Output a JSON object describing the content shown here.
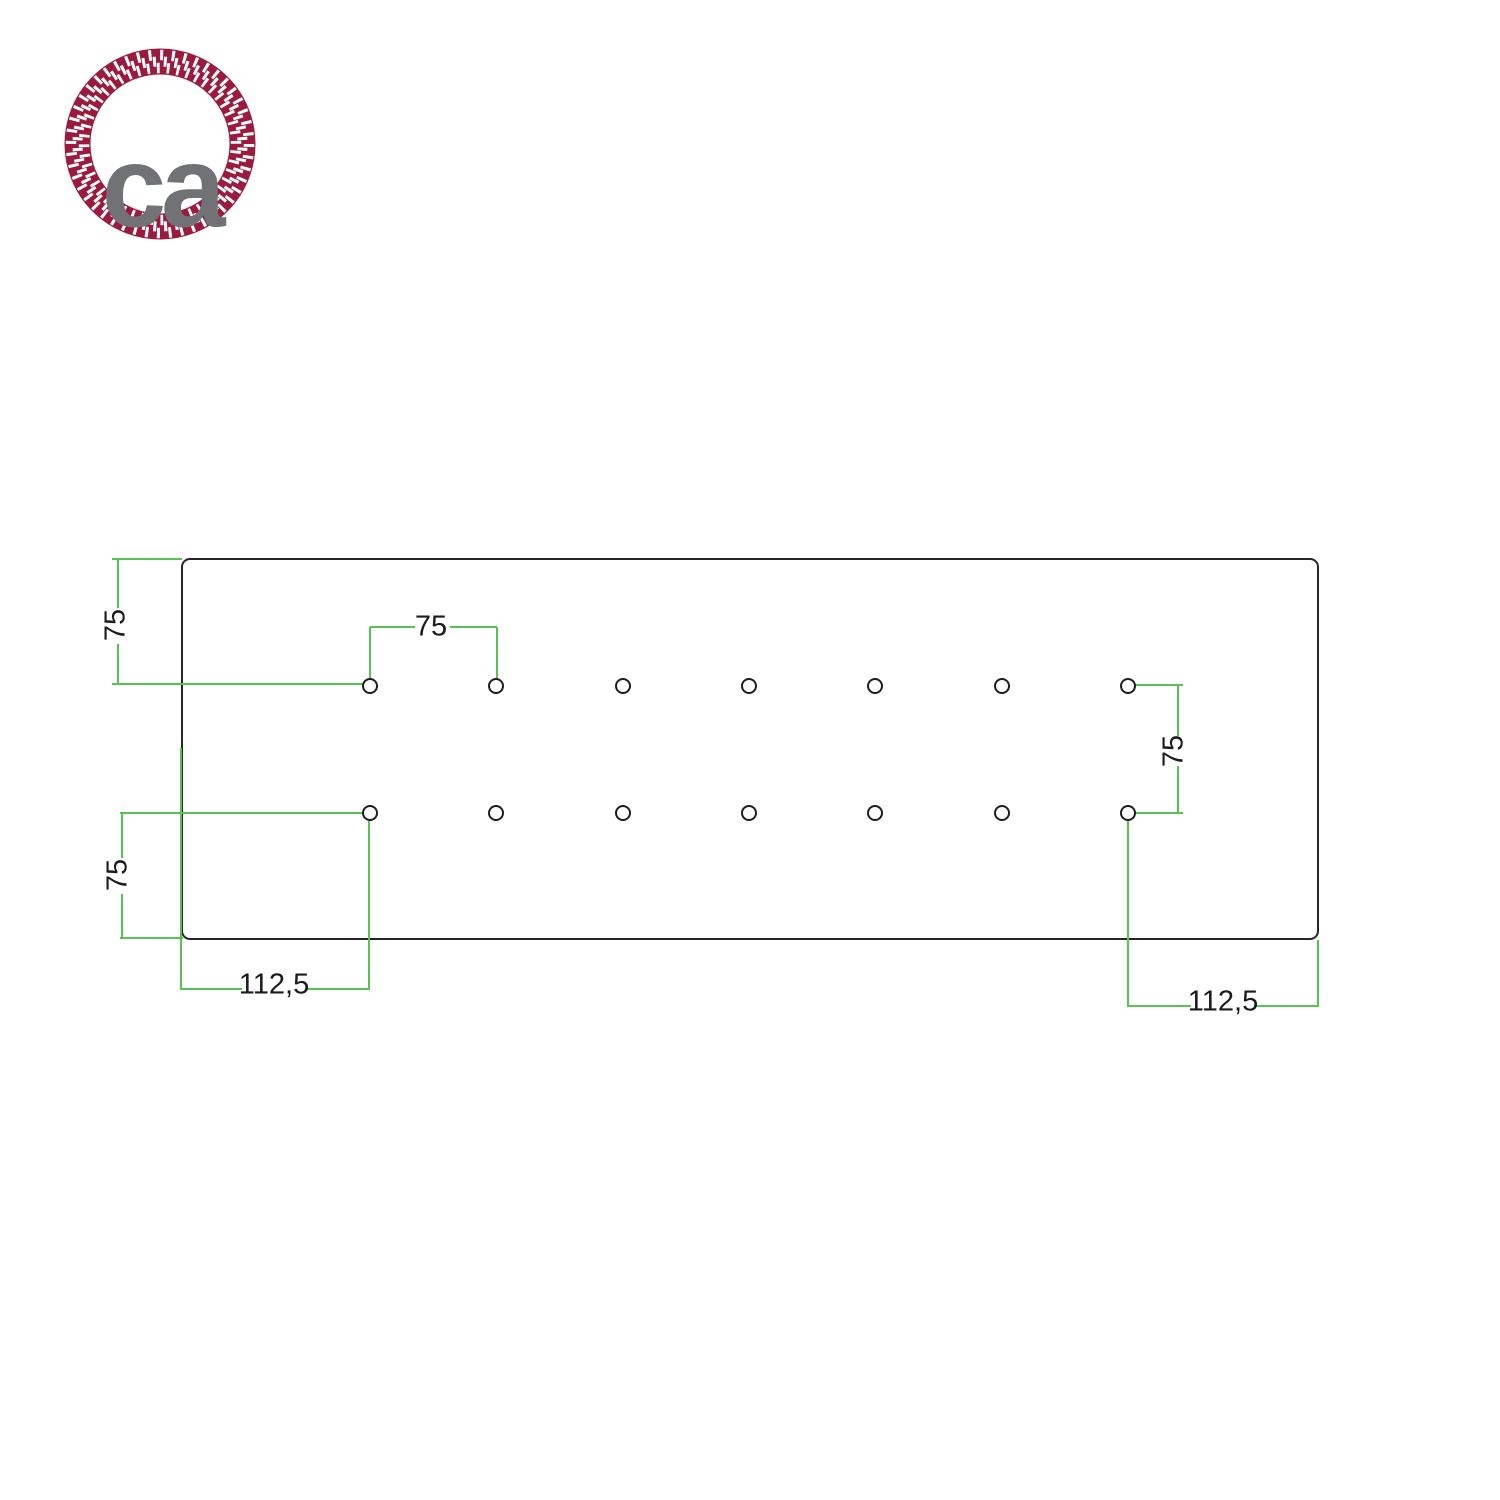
{
  "logo": {
    "text": "ca",
    "rope_color": "#9b1b3e",
    "text_color": "#717275"
  },
  "drawing": {
    "type": "technical-dimension-drawing",
    "line_color": "#57c355",
    "outline_color": "#262626",
    "holes": {
      "rows": 2,
      "columns": 7,
      "total": 14
    },
    "dimensions": {
      "plate_top_to_hole_row": "75",
      "hole_horizontal_spacing": "75",
      "hole_row_vertical_spacing": "75",
      "hole_row_to_plate_bottom": "75",
      "left_edge_to_first_hole": "112,5",
      "right_edge_to_last_hole": "112,5"
    }
  }
}
